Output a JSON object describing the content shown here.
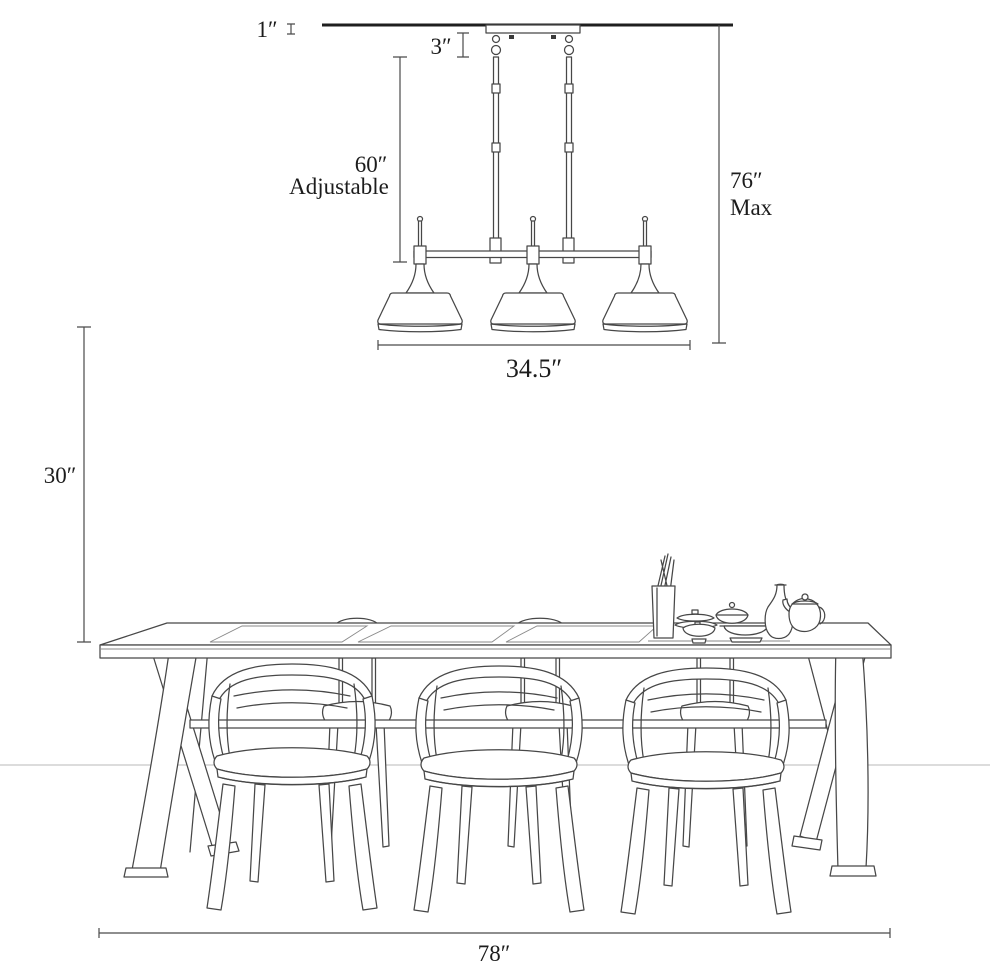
{
  "colors": {
    "ink": "#474747",
    "dim_line": "#4a4a4a",
    "faint_line": "#b9b9b9",
    "subtle": "#8a8a8a",
    "text": "#1c1c1c",
    "ceiling": "#1f1f1f",
    "paper": "#ffffff"
  },
  "labels": {
    "canopy_height": "1″",
    "hanger_height": "3″",
    "cord_length": "60″",
    "cord_note": "Adjustable",
    "max_height": "76″",
    "max_note": "Max",
    "fixture_width": "34.5″",
    "table_height": "30″",
    "table_length": "78″"
  }
}
